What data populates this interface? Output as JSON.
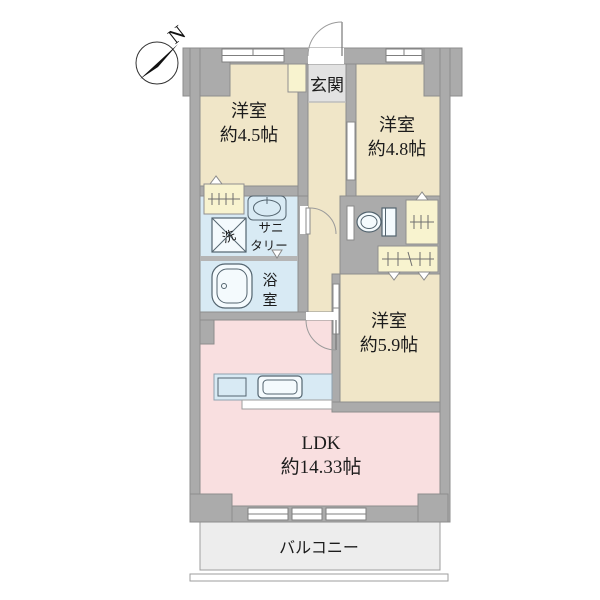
{
  "compass": {
    "north_label": "N"
  },
  "entrance": {
    "label": "玄関"
  },
  "rooms": [
    {
      "id": "western-room-1",
      "label": "洋室",
      "size": "約4.5帖"
    },
    {
      "id": "western-room-2",
      "label": "洋室",
      "size": "約4.8帖"
    },
    {
      "id": "western-room-3",
      "label": "洋室",
      "size": "約5.9帖"
    },
    {
      "id": "ldk",
      "label": "LDK",
      "size": "約14.33帖"
    }
  ],
  "wet_areas": {
    "sanitary_line1": "サニ",
    "sanitary_line2": "タリー",
    "laundry": "洗",
    "bath_char1": "浴",
    "bath_char2": "室"
  },
  "balcony": {
    "label": "バルコニー"
  },
  "palette": {
    "wall_gray": "#ababab",
    "room_cream": "#f0e6c8",
    "wet_blue": "#d8eaf4",
    "ldk_pink": "#f9dfe0",
    "closet_yellow": "#f8f3cf",
    "balcony_gray": "#ededed",
    "entrance_tile": "#e2e2e2",
    "fixture_stroke": "#53646f"
  }
}
